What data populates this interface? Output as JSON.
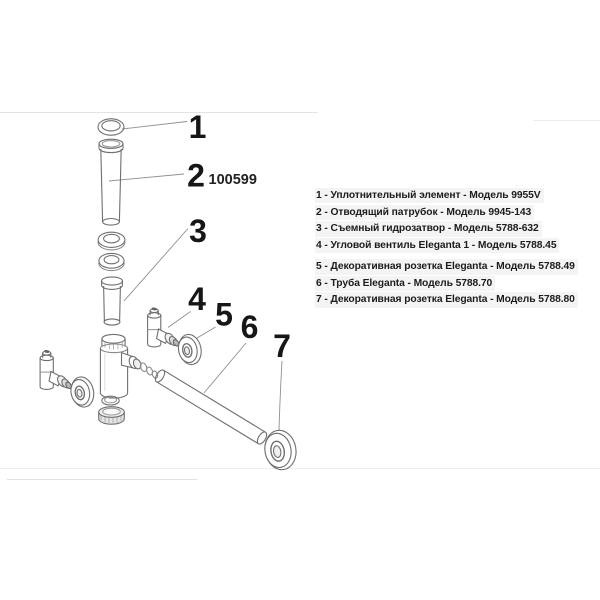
{
  "colors": {
    "line": "#6f6f6f",
    "light_line": "#8a8a8a",
    "leader": "#8f8f8f",
    "faint_rule": "#e6e6e6",
    "text": "#1c1c1c",
    "list_highlight": "#f4f4f4"
  },
  "article_number": "100599",
  "callouts": [
    "1",
    "2",
    "3",
    "4",
    "5",
    "6",
    "7"
  ],
  "parts_list": {
    "items": [
      "1 - Уплотнительный элемент - Модель 9955V",
      "2 - Отводящий патрубок - Модель 9945-143",
      "3 - Съемный гидрозатвор - Модель 5788-632",
      "4 - Угловой вентиль Eleganta 1 - Модель 5788.45",
      "5 - Декоративная розетка Eleganta - Модель 5788.49",
      "6 - Труба Eleganta - Модель 5788.70",
      "7 - Декоративная розетка Eleganta - Модель 5788.80"
    ]
  }
}
